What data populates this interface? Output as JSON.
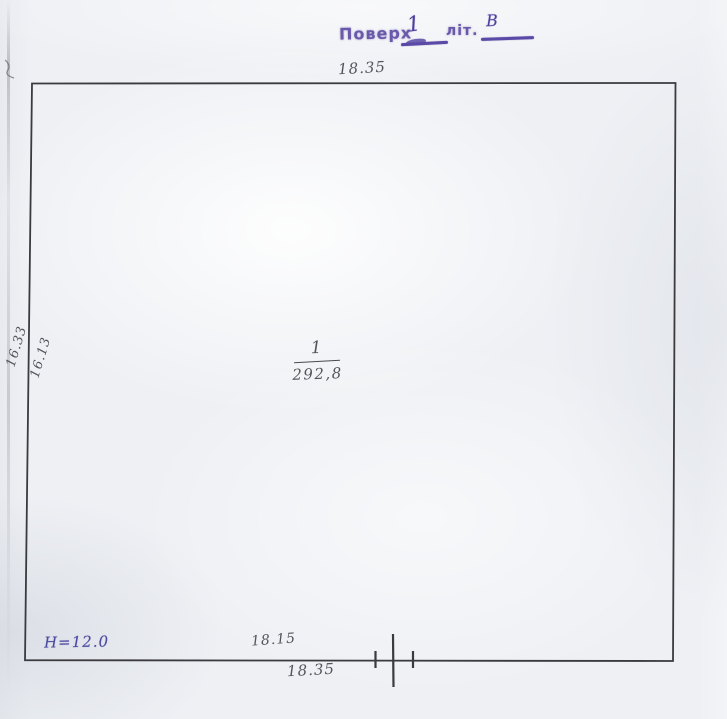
{
  "stamp": {
    "floor_label": "Поверх",
    "floor_value": "1",
    "liter_label": "літ.",
    "liter_value": "В"
  },
  "plan": {
    "room_number": "1",
    "room_area": "292,8",
    "height_note": "Н=12.0",
    "dim_top": "18.35",
    "dim_left_outer": "16.33",
    "dim_left_inner": "16.13",
    "dim_bottom_inner": "18.15",
    "dim_bottom_outer": "18.35"
  },
  "colors": {
    "stamp_ink": "#6a58ab",
    "pen_ink": "#4b48a0",
    "pencil_gray": "#55545c",
    "outline_line": "#3b3a3e",
    "paper": "#edeff3"
  }
}
